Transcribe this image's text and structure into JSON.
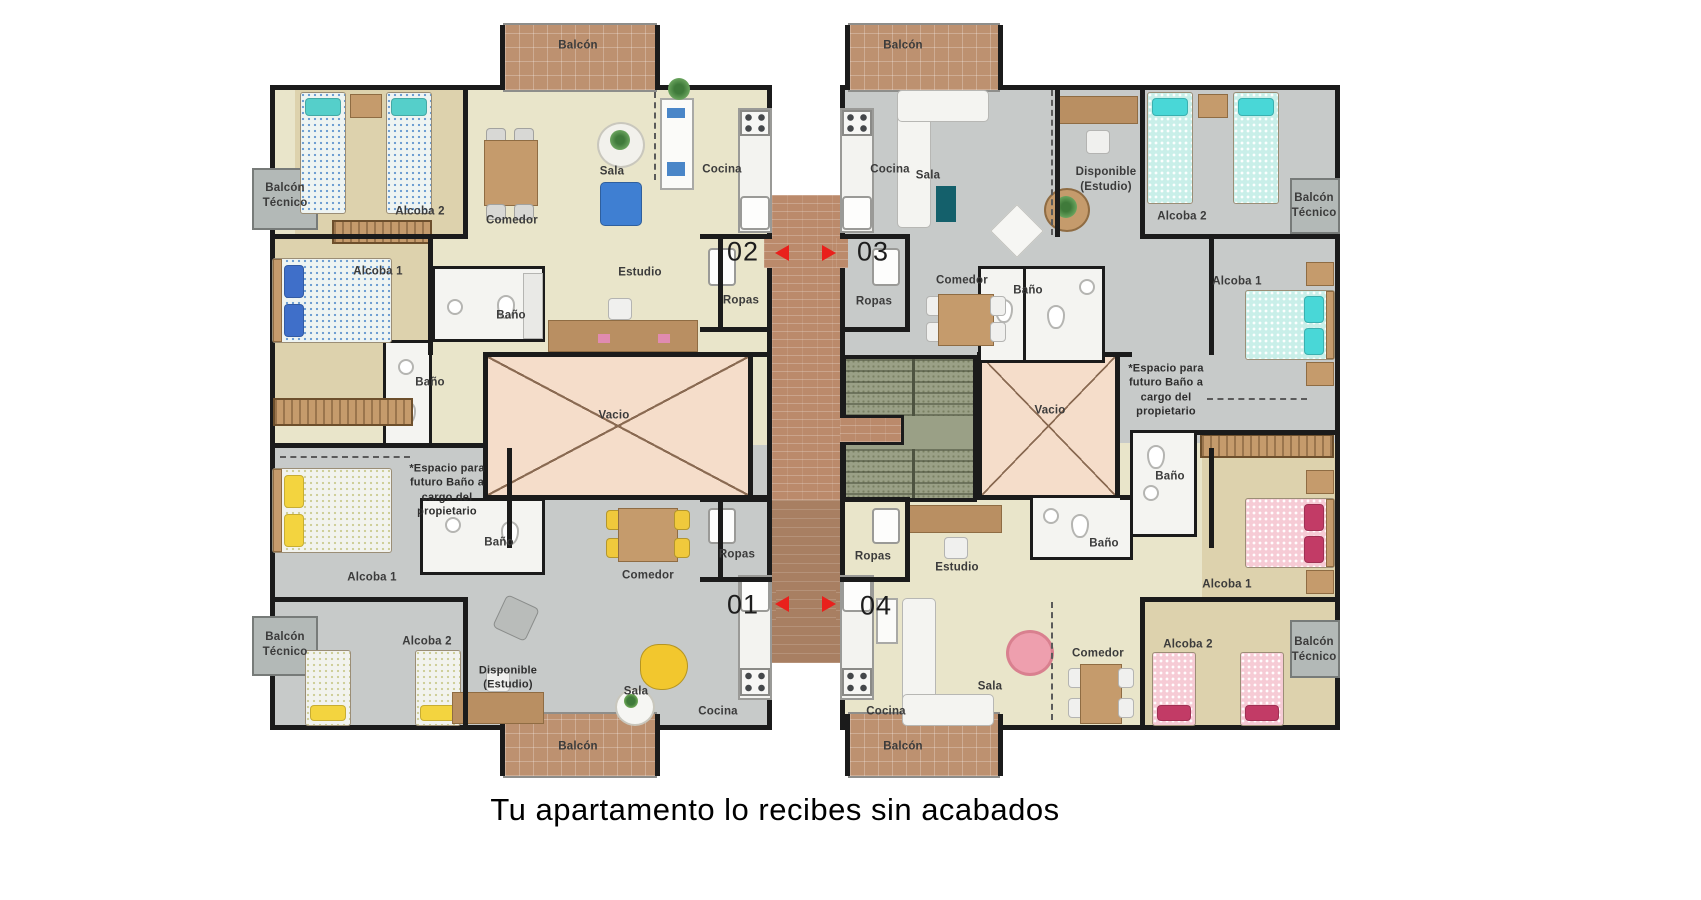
{
  "caption": "Tu apartamento lo recibes sin acabados",
  "units": [
    {
      "number": "01",
      "position": "bottom-left"
    },
    {
      "number": "02",
      "position": "top-left"
    },
    {
      "number": "03",
      "position": "top-right"
    },
    {
      "number": "04",
      "position": "bottom-right"
    }
  ],
  "unit_numbers": [
    {
      "name": "unit-number-02",
      "text": "02",
      "x": 743,
      "y": 252
    },
    {
      "name": "unit-number-03",
      "text": "03",
      "x": 873,
      "y": 252
    },
    {
      "name": "unit-number-01",
      "text": "01",
      "x": 743,
      "y": 605
    },
    {
      "name": "unit-number-04",
      "text": "04",
      "x": 876,
      "y": 606
    }
  ],
  "labels": [
    {
      "name": "label-balcony-top-left",
      "text": "Balcón",
      "x": 578,
      "y": 46
    },
    {
      "name": "label-balcony-top-right",
      "text": "Balcón",
      "x": 903,
      "y": 46
    },
    {
      "name": "label-balcony-bottom-left",
      "text": "Balcón",
      "x": 578,
      "y": 747
    },
    {
      "name": "label-balcony-bottom-right",
      "text": "Balcón",
      "x": 903,
      "y": 747
    },
    {
      "name": "label-tech-balcony-top-left",
      "text": "Balcón\nTécnico",
      "x": 285,
      "y": 196
    },
    {
      "name": "label-tech-balcony-bottom-left",
      "text": "Balcón\nTécnico",
      "x": 285,
      "y": 645
    },
    {
      "name": "label-tech-balcony-top-right",
      "text": "Balcón\nTécnico",
      "x": 1314,
      "y": 206
    },
    {
      "name": "label-tech-balcony-bottom-right",
      "text": "Balcón\nTécnico",
      "x": 1314,
      "y": 650
    },
    {
      "name": "label-alcoba2-02",
      "text": "Alcoba 2",
      "x": 420,
      "y": 212
    },
    {
      "name": "label-comedor-02",
      "text": "Comedor",
      "x": 512,
      "y": 221
    },
    {
      "name": "label-sala-02",
      "text": "Sala",
      "x": 612,
      "y": 172
    },
    {
      "name": "label-cocina-02",
      "text": "Cocina",
      "x": 722,
      "y": 170
    },
    {
      "name": "label-alcoba1-02",
      "text": "Alcoba 1",
      "x": 378,
      "y": 272
    },
    {
      "name": "label-estudio-02",
      "text": "Estudio",
      "x": 640,
      "y": 273
    },
    {
      "name": "label-bano1-02",
      "text": "Baño",
      "x": 511,
      "y": 316
    },
    {
      "name": "label-bano2-02",
      "text": "Baño",
      "x": 430,
      "y": 383
    },
    {
      "name": "label-ropas-02",
      "text": "Ropas",
      "x": 741,
      "y": 301
    },
    {
      "name": "label-vacio-left",
      "text": "Vacio",
      "x": 614,
      "y": 416
    },
    {
      "name": "label-cocina-03",
      "text": "Cocina",
      "x": 890,
      "y": 170
    },
    {
      "name": "label-sala-03",
      "text": "Sala",
      "x": 928,
      "y": 176
    },
    {
      "name": "label-disponible-03",
      "text": "Disponible\n(Estudio)",
      "x": 1106,
      "y": 180
    },
    {
      "name": "label-alcoba2-03",
      "text": "Alcoba 2",
      "x": 1182,
      "y": 217
    },
    {
      "name": "label-alcoba1-03",
      "text": "Alcoba 1",
      "x": 1237,
      "y": 282
    },
    {
      "name": "label-comedor-03",
      "text": "Comedor",
      "x": 962,
      "y": 281
    },
    {
      "name": "label-ropas-03",
      "text": "Ropas",
      "x": 874,
      "y": 302
    },
    {
      "name": "label-bano-03",
      "text": "Baño",
      "x": 1028,
      "y": 291
    },
    {
      "name": "label-vacio-right",
      "text": "Vacio",
      "x": 1050,
      "y": 411
    },
    {
      "name": "label-note-03",
      "kind": "note",
      "text": "*Espacio para\nfuturo Baño a\ncargo del\npropietario",
      "x": 1166,
      "y": 390
    },
    {
      "name": "label-alcoba1-01",
      "text": "Alcoba 1",
      "x": 372,
      "y": 578
    },
    {
      "name": "label-alcoba2-01",
      "text": "Alcoba 2",
      "x": 427,
      "y": 642
    },
    {
      "name": "label-disponible-01",
      "kind": "note",
      "text": "Disponible\n(Estudio)",
      "x": 508,
      "y": 678
    },
    {
      "name": "label-sala-01",
      "text": "Sala",
      "x": 636,
      "y": 692
    },
    {
      "name": "label-cocina-01",
      "text": "Cocina",
      "x": 718,
      "y": 712
    },
    {
      "name": "label-comedor-01",
      "text": "Comedor",
      "x": 648,
      "y": 576
    },
    {
      "name": "label-ropas-01",
      "text": "Ropas",
      "x": 737,
      "y": 555
    },
    {
      "name": "label-bano-01",
      "text": "Baño",
      "x": 499,
      "y": 543
    },
    {
      "name": "label-note-01",
      "kind": "note",
      "text": "*Espacio para\nfuturo Baño a\ncargo del\npropietario",
      "x": 447,
      "y": 490
    },
    {
      "name": "label-ropas-04",
      "text": "Ropas",
      "x": 873,
      "y": 557
    },
    {
      "name": "label-estudio-04",
      "text": "Estudio",
      "x": 957,
      "y": 568
    },
    {
      "name": "label-sala-04",
      "text": "Sala",
      "x": 990,
      "y": 687
    },
    {
      "name": "label-cocina-04",
      "text": "Cocina",
      "x": 886,
      "y": 712
    },
    {
      "name": "label-comedor-04",
      "text": "Comedor",
      "x": 1098,
      "y": 654
    },
    {
      "name": "label-alcoba1-04",
      "text": "Alcoba 1",
      "x": 1227,
      "y": 585
    },
    {
      "name": "label-alcoba2-04",
      "text": "Alcoba 2",
      "x": 1188,
      "y": 645
    },
    {
      "name": "label-bano1-04",
      "text": "Baño",
      "x": 1170,
      "y": 477
    },
    {
      "name": "label-bano2-04",
      "text": "Baño",
      "x": 1104,
      "y": 544
    }
  ],
  "door_arrows": [
    {
      "name": "door-arrow-left-top",
      "dir": "left",
      "x": 775,
      "y": 245
    },
    {
      "name": "door-arrow-right-top",
      "dir": "right",
      "x": 822,
      "y": 245
    },
    {
      "name": "door-arrow-left-bottom",
      "dir": "left",
      "x": 775,
      "y": 596
    },
    {
      "name": "door-arrow-right-bottom",
      "dir": "right",
      "x": 822,
      "y": 596
    }
  ],
  "colors": {
    "arrow_red": "#e9201c",
    "wall_black": "#1b1b1b",
    "corridor_brick": "#bb8a6b",
    "balcony_tile": "#bd9170",
    "vacio_pink": "#f5ddca",
    "stairs_green": "#9aa086",
    "floor_beige": "#e9e5ca",
    "floor_tan": "#ddd2ad",
    "floor_gray": "#c7cac9",
    "bed_cyan": "#49d7d7",
    "bed_blue": "#3f6fc9",
    "bed_yellow": "#f3d43f",
    "bed_magenta": "#c23b66"
  }
}
